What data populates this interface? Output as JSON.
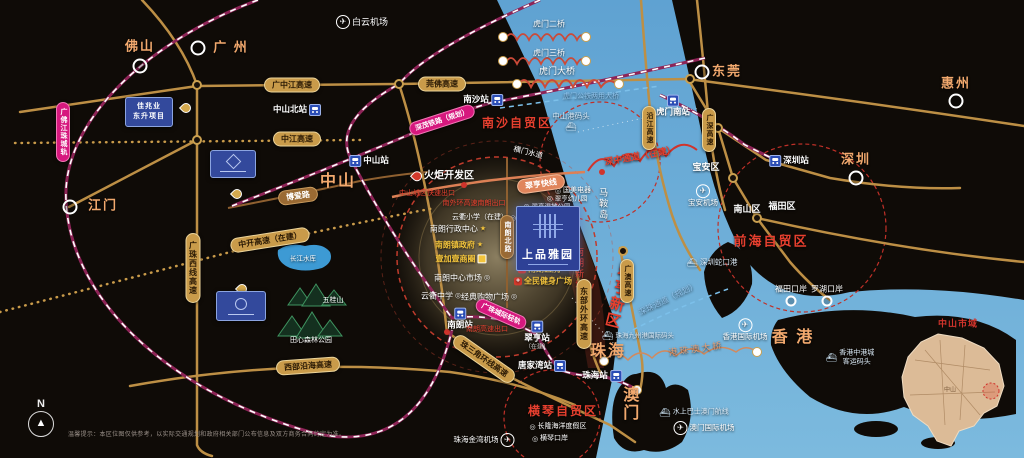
{
  "project": {
    "title": "上品雅园"
  },
  "compass": {
    "label": "N"
  },
  "disclaimer": "温馨提示：本区位图仅供参考，以实际交通规划和政府相关部门公布信息及双方商务合同约定为准。",
  "inset": {
    "title": "中山市域",
    "label": "中山"
  },
  "icons": {
    "airport": "✈",
    "ship": "⛴",
    "star": "★",
    "school": "◎",
    "plus": "+"
  },
  "cities": [
    {
      "name": "佛山",
      "x": 140,
      "y": 47,
      "ring": [
        140,
        66
      ]
    },
    {
      "name": "广 州",
      "x": 231,
      "y": 48,
      "ring": [
        198,
        48
      ]
    },
    {
      "name": "东莞",
      "x": 727,
      "y": 72,
      "ring": [
        702,
        72
      ]
    },
    {
      "name": "惠州",
      "x": 956,
      "y": 84,
      "ring": [
        956,
        101
      ]
    },
    {
      "name": "深圳",
      "x": 856,
      "y": 160,
      "ring": [
        856,
        178
      ]
    },
    {
      "name": "江门",
      "x": 103,
      "y": 206,
      "ring": [
        70,
        207
      ]
    },
    {
      "name": "中山",
      "x": 338,
      "y": 182,
      "big": true
    },
    {
      "name": "珠海",
      "x": 608,
      "y": 352,
      "big": true
    },
    {
      "name": "香 港",
      "x": 793,
      "y": 338,
      "big": true
    },
    {
      "name": "澳门",
      "x": 628,
      "y": 404,
      "big": true,
      "vert": true
    }
  ],
  "stations": [
    {
      "name": "中山北站",
      "x": 297,
      "y": 110,
      "icon": "right"
    },
    {
      "name": "中山站",
      "x": 369,
      "y": 161,
      "icon": "left"
    },
    {
      "name": "南沙站",
      "x": 483,
      "y": 100,
      "icon": "right"
    },
    {
      "name": "虎门南站",
      "x": 673,
      "y": 106,
      "icon": "top"
    },
    {
      "name": "深圳站",
      "x": 789,
      "y": 161,
      "icon": "left"
    },
    {
      "name": "南朗站",
      "x": 460,
      "y": 319,
      "icon": "top"
    },
    {
      "name": "翠亨站",
      "x": 537,
      "y": 336,
      "icon": "top",
      "sub": "（在建）"
    },
    {
      "name": "唐家湾站",
      "x": 542,
      "y": 366,
      "icon": "right"
    },
    {
      "name": "珠海站",
      "x": 602,
      "y": 376,
      "icon": "right"
    }
  ],
  "airports": [
    {
      "name": "白云机场",
      "x": 362,
      "y": 22,
      "icon": "left",
      "size": 9
    },
    {
      "name": "宝安机场",
      "x": 703,
      "y": 196,
      "icon": "top",
      "size": 7.5
    },
    {
      "name": "香港国际机场",
      "x": 745,
      "y": 330,
      "icon": "top",
      "size": 7.5
    },
    {
      "name": "澳门国际机场",
      "x": 704,
      "y": 428,
      "icon": "left",
      "size": 7.5
    },
    {
      "name": "珠海金湾机场",
      "x": 484,
      "y": 440,
      "icon": "right",
      "size": 7.5
    }
  ],
  "ports": [
    {
      "lines": [
        "中山港码头"
      ],
      "x": 571,
      "y": 122,
      "icon": "bottom",
      "size": 7.5
    },
    {
      "lines": [
        "深圳蛇口港"
      ],
      "x": 712,
      "y": 263,
      "icon": "left",
      "size": 7.5
    },
    {
      "lines": [
        "珠海九州港国际码头"
      ],
      "x": 638,
      "y": 336,
      "icon": "left",
      "size": 6.5
    },
    {
      "lines": [
        "香港中港城",
        "客运码头"
      ],
      "x": 850,
      "y": 358,
      "icon": "left",
      "size": 7
    },
    {
      "lines": [
        "水上巴士澳门航线"
      ],
      "x": 694,
      "y": 413,
      "icon": "left",
      "size": 7
    }
  ],
  "checkpoints": [
    {
      "name": "福田口岸",
      "x": 791,
      "y": 289,
      "ring": [
        791,
        301
      ]
    },
    {
      "name": "罗湖口岸",
      "x": 827,
      "y": 289,
      "ring": [
        827,
        301
      ]
    }
  ],
  "districts": [
    {
      "name": "宝安区",
      "x": 706,
      "y": 167
    },
    {
      "name": "南山区",
      "x": 747,
      "y": 209
    },
    {
      "name": "福田区",
      "x": 782,
      "y": 206
    }
  ],
  "zones": [
    {
      "name": "南沙自贸区",
      "x": 517,
      "y": 124,
      "size": 12
    },
    {
      "name": "前海自贸区",
      "x": 771,
      "y": 242,
      "size": 13
    },
    {
      "name": "横琴自贸区",
      "x": 563,
      "y": 412,
      "size": 12
    }
  ],
  "road_pills": [
    {
      "name": "广中江高速",
      "x": 292,
      "y": 85
    },
    {
      "name": "中江高速",
      "x": 297,
      "y": 139
    },
    {
      "name": "莞佛高速",
      "x": 442,
      "y": 84
    },
    {
      "name": "广珠西线高速",
      "x": 193,
      "y": 268,
      "vert": true
    },
    {
      "name": "中开高速（在建）",
      "x": 270,
      "y": 240,
      "rot": -9
    },
    {
      "name": "东部外环高速",
      "x": 584,
      "y": 314,
      "vert": true
    },
    {
      "name": "珠三角环线高速",
      "x": 484,
      "y": 359,
      "rot": 35
    },
    {
      "name": "西部沿海高速",
      "x": 308,
      "y": 366,
      "rot": -4
    },
    {
      "name": "广澳高速",
      "x": 627,
      "y": 281,
      "vert": true,
      "small": true
    },
    {
      "name": "沿江高速",
      "x": 649,
      "y": 128,
      "vert": true,
      "small": true
    },
    {
      "name": "广深高速",
      "x": 709,
      "y": 130,
      "vert": true,
      "small": true
    },
    {
      "name": "博爱路",
      "x": 298,
      "y": 196,
      "rot": -8,
      "cls": "brown"
    },
    {
      "name": "南朗北路",
      "x": 507,
      "y": 237,
      "vert": true,
      "cls": "brown",
      "small": true
    },
    {
      "name": "翠亨快线",
      "x": 541,
      "y": 184,
      "rot": -8,
      "cls": "salmon"
    }
  ],
  "rail_pills": [
    {
      "name": "深茂铁路（规划）",
      "x": 442,
      "y": 120,
      "rot": -18
    },
    {
      "name": "广珠城际轻轨",
      "x": 501,
      "y": 314,
      "rot": 24
    },
    {
      "name": "广佛江珠城轨",
      "x": 63,
      "y": 132,
      "vert": true
    }
  ],
  "bridge_labels": [
    {
      "name": "虎门二桥",
      "x": 549,
      "y": 24,
      "c": "w",
      "size": 8
    },
    {
      "name": "虎门三桥",
      "x": 549,
      "y": 53,
      "c": "w",
      "size": 8
    },
    {
      "name": "虎门大桥",
      "x": 557,
      "y": 71,
      "c": "w",
      "size": 9
    },
    {
      "name": "虎门公铁两用大桥",
      "x": 591,
      "y": 97,
      "c": "blue",
      "size": 7
    },
    {
      "name": "深中通道（在建）",
      "x": 640,
      "y": 156,
      "c": "r",
      "size": 9,
      "rot": -10,
      "b": true
    },
    {
      "name": "深珠通道（规划）",
      "x": 668,
      "y": 299,
      "c": "blue",
      "size": 8,
      "rot": -26
    },
    {
      "name": "港珠澳大桥",
      "x": 696,
      "y": 349,
      "c": "salmon",
      "size": 9,
      "rot": -8,
      "ls": 2
    }
  ],
  "vtexts": [
    {
      "name": "翠亨新区",
      "x": 618,
      "y": 296,
      "c": "r",
      "size": 15,
      "rot": 14,
      "b": true
    },
    {
      "name": "南朗新城",
      "x": 579,
      "y": 269,
      "c": "r",
      "size": 9
    },
    {
      "name": "马鞍岛",
      "x": 603,
      "y": 204,
      "c": "w",
      "size": 9
    }
  ],
  "water_labels": [
    {
      "name": "横门水道",
      "x": 528,
      "y": 153,
      "c": "w",
      "size": 7.5,
      "rot": 14
    }
  ],
  "nature": [
    {
      "name": "长江水库",
      "x": 303,
      "y": 259,
      "size": 6.5
    },
    {
      "name": "五桂山",
      "x": 333,
      "y": 301,
      "size": 7
    },
    {
      "name": "田心森林公园",
      "x": 311,
      "y": 341,
      "size": 7
    }
  ],
  "pois": [
    {
      "name": "火炬开发区",
      "x": 443,
      "y": 176,
      "c": "w",
      "size": 10,
      "b": true,
      "icon": "pinred",
      "is": "left"
    },
    {
      "name": "中山城区快速出口",
      "x": 427,
      "y": 194,
      "c": "r",
      "size": 7
    },
    {
      "name": "南外环高速南朗出口",
      "x": 474,
      "y": 204,
      "c": "r",
      "size": 7
    },
    {
      "name": "云衢小学（在建）",
      "x": 484,
      "y": 218,
      "c": "w",
      "size": 7,
      "icon": "school",
      "is": "right"
    },
    {
      "name": "南朗行政中心",
      "x": 458,
      "y": 229,
      "c": "w",
      "size": 8,
      "icon": "star",
      "is": "right"
    },
    {
      "name": "南朗镇政府",
      "x": 459,
      "y": 245,
      "c": "y",
      "size": 8,
      "b": true,
      "icon": "star",
      "is": "right"
    },
    {
      "name": "壹加壹商圈",
      "x": 461,
      "y": 259,
      "c": "y",
      "size": 8,
      "b": true,
      "icon": "bag",
      "is": "right"
    },
    {
      "name": "南朗中心市场",
      "x": 462,
      "y": 278,
      "c": "w",
      "size": 8,
      "icon": "school",
      "is": "right"
    },
    {
      "name": "云衢中学",
      "x": 441,
      "y": 296,
      "c": "w",
      "size": 8,
      "icon": "school",
      "is": "right"
    },
    {
      "name": "经典购物广场",
      "x": 489,
      "y": 297,
      "c": "w",
      "size": 8,
      "icon": "school",
      "is": "right"
    },
    {
      "name": "国美电器",
      "x": 573,
      "y": 191,
      "c": "w",
      "size": 7,
      "icon": "school",
      "is": "left"
    },
    {
      "name": "翠亨幼儿园",
      "x": 567,
      "y": 199,
      "c": "w",
      "size": 6.5,
      "icon": "school",
      "is": "left"
    },
    {
      "name": "翠亨湿地公园",
      "x": 547,
      "y": 207,
      "c": "w",
      "size": 6.5,
      "icon": "school",
      "is": "left"
    },
    {
      "name": "南朗医院",
      "x": 539,
      "y": 269,
      "c": "y",
      "size": 8,
      "b": true,
      "icon": "plus",
      "is": "left"
    },
    {
      "name": "全民健身广场",
      "x": 543,
      "y": 281,
      "c": "y",
      "size": 8,
      "b": true,
      "icon": "plus",
      "is": "left"
    },
    {
      "name": "南朗高速出口",
      "x": 487,
      "y": 330,
      "c": "r",
      "size": 7
    },
    {
      "name": "长隆海洋度假区",
      "x": 558,
      "y": 427,
      "c": "w",
      "size": 7,
      "icon": "school",
      "is": "left"
    },
    {
      "name": "横琴口岸",
      "x": 550,
      "y": 439,
      "c": "w",
      "size": 7,
      "icon": "school",
      "is": "left"
    }
  ],
  "logo_cards": [
    {
      "lines": [
        "佳兆业",
        "东升项目"
      ],
      "x": 149,
      "y": 112,
      "w": 46,
      "h": 28
    },
    {
      "lines": [],
      "x": 233,
      "y": 164,
      "w": 44,
      "h": 26,
      "glyph": "diamond"
    },
    {
      "lines": [],
      "x": 241,
      "y": 306,
      "w": 48,
      "h": 28,
      "glyph": "round"
    }
  ],
  "pins": [
    [
      181,
      103
    ],
    [
      232,
      189
    ],
    [
      237,
      284
    ]
  ],
  "nodes": [
    [
      197,
      85
    ],
    [
      197,
      140
    ],
    [
      399,
      84
    ],
    [
      690,
      79
    ],
    [
      718,
      128
    ],
    [
      733,
      178
    ],
    [
      757,
      218
    ],
    [
      623,
      251
    ]
  ],
  "red_dots": [
    [
      447,
      332
    ],
    [
      464,
      185
    ],
    [
      602,
      172
    ]
  ],
  "white_dots": [
    [
      503,
      37
    ],
    [
      586,
      37
    ],
    [
      503,
      61
    ],
    [
      586,
      61
    ],
    [
      517,
      84
    ],
    [
      619,
      84
    ],
    [
      757,
      352
    ],
    [
      637,
      390
    ],
    [
      604,
      361
    ]
  ]
}
